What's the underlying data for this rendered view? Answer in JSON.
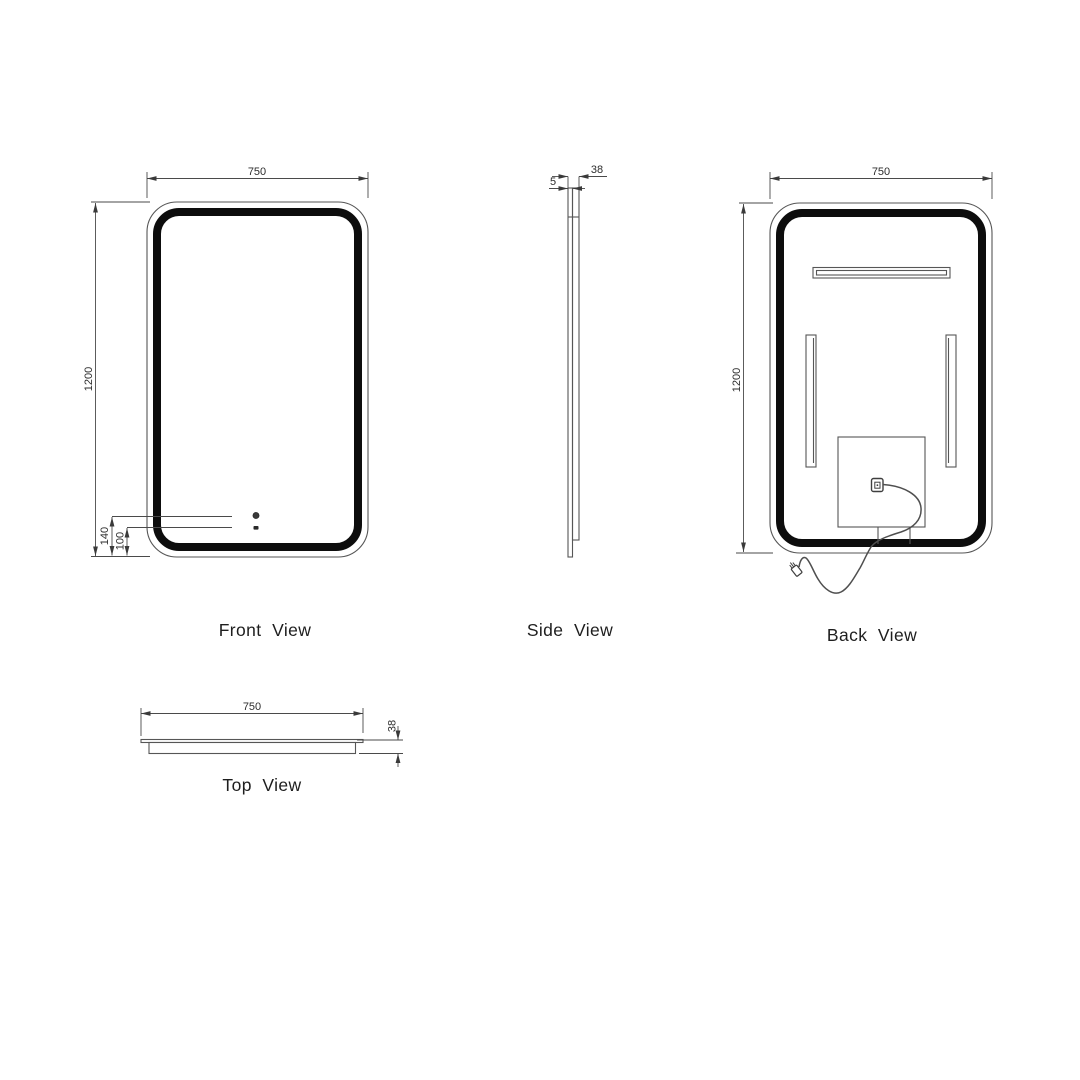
{
  "views": {
    "front": {
      "label": "Front  View",
      "width_mm": "750",
      "height_mm": "1200",
      "sensor_offset_mm": "140",
      "button_offset_mm": "100"
    },
    "side": {
      "label": "Side  View",
      "glass_thickness_mm": "5",
      "depth_mm": "38"
    },
    "back": {
      "label": "Back  View",
      "width_mm": "750",
      "height_mm": "1200"
    },
    "top": {
      "label": "Top  View",
      "width_mm": "750",
      "depth_mm": "38"
    }
  },
  "colors": {
    "background": "#ffffff",
    "thin_line": "#565656",
    "led_frame": "#0d0d0d"
  }
}
